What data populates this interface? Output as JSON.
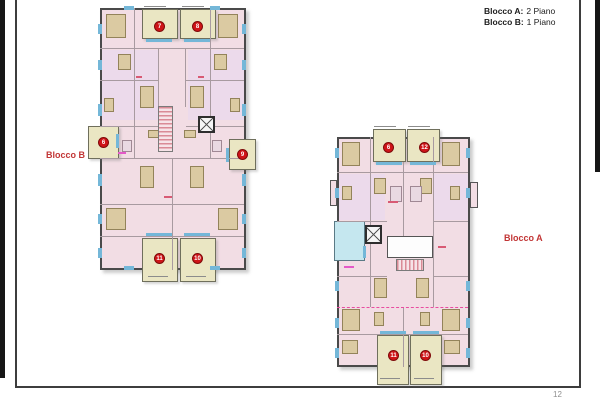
{
  "page": {
    "number": "12"
  },
  "legend": {
    "line1_label": "Blocco A:",
    "line1_value": "2 Piano",
    "line2_label": "Blocco B:",
    "line2_value": "1 Piano"
  },
  "plans": {
    "blocco_b": {
      "label": "Blocco B",
      "units": [
        {
          "number": "7",
          "location": "top-left-terrace"
        },
        {
          "number": "8",
          "location": "top-right-terrace"
        },
        {
          "number": "6",
          "location": "left-balcony"
        },
        {
          "number": "9",
          "location": "right-balcony"
        },
        {
          "number": "11",
          "location": "bottom-left-terrace"
        },
        {
          "number": "10",
          "location": "bottom-right-terrace"
        }
      ]
    },
    "blocco_a": {
      "label": "Blocco A",
      "units": [
        {
          "number": "6",
          "location": "top-left-terrace"
        },
        {
          "number": "12",
          "location": "top-right-terrace"
        },
        {
          "number": "11",
          "location": "bottom-left-terrace"
        },
        {
          "number": "10",
          "location": "bottom-right-terrace"
        }
      ]
    }
  },
  "colors": {
    "room_fill": "#f2dde4",
    "terrace_fill": "#eae6c3",
    "window_blue": "#74b7d8",
    "cyan_terrace": "#c5e7ef",
    "unit_marker_red": "#cf1418",
    "label_red": "#c23535"
  }
}
